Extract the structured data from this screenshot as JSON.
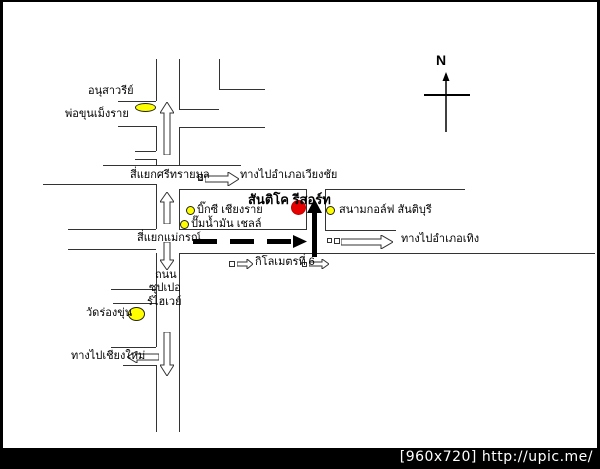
{
  "watermark": {
    "text": "[960x720] http://upic.me/"
  },
  "compass": {
    "north_label": "N"
  },
  "map": {
    "landmarks": {
      "monument": {
        "name_line1": "อนุสาวรีย์",
        "name_line2": "พ่อขุนเม็งราย",
        "marker_color": "#ffff00"
      },
      "bigc": {
        "name": "บิ๊กซี เชียงราย",
        "marker_color": "#ffff00"
      },
      "shell": {
        "name": "ปั๊มน้ำมัน เชลล์",
        "marker_color": "#ffff00"
      },
      "resort": {
        "name": "สันติโค รีสอร์ท",
        "marker_color": "#e60000"
      },
      "golf": {
        "name": "สนามกอล์ฟ สันติบุรี",
        "marker_color": "#ffff00"
      },
      "wat": {
        "name": "วัดร่องขุ่น",
        "marker_color": "#ffff00"
      }
    },
    "junctions": {
      "srisaimun": {
        "name": "สี่แยกศรีทรายมูล"
      },
      "maekorn": {
        "name": "สี่แยกแม่กรณ์"
      }
    },
    "directions": {
      "wiangchai": {
        "label": "ทางไปอำเภอเวียงชัย"
      },
      "thoeng": {
        "label": "ทางไปอำเภอเทิง"
      },
      "chiangmai": {
        "label": "ทางไปเชียงใหม่"
      }
    },
    "road_labels": {
      "superhighway_line1": "ถนน",
      "superhighway_line2": "ซุปเปอ",
      "superhighway_line3": "ร์ไฮเวย์",
      "km6": "กิโลเมตรที่ 6"
    },
    "colors": {
      "road_line": "#333333",
      "marker_yellow": "#ffff00",
      "marker_red": "#e60000",
      "background": "#ffffff",
      "frame": "#000000"
    }
  }
}
